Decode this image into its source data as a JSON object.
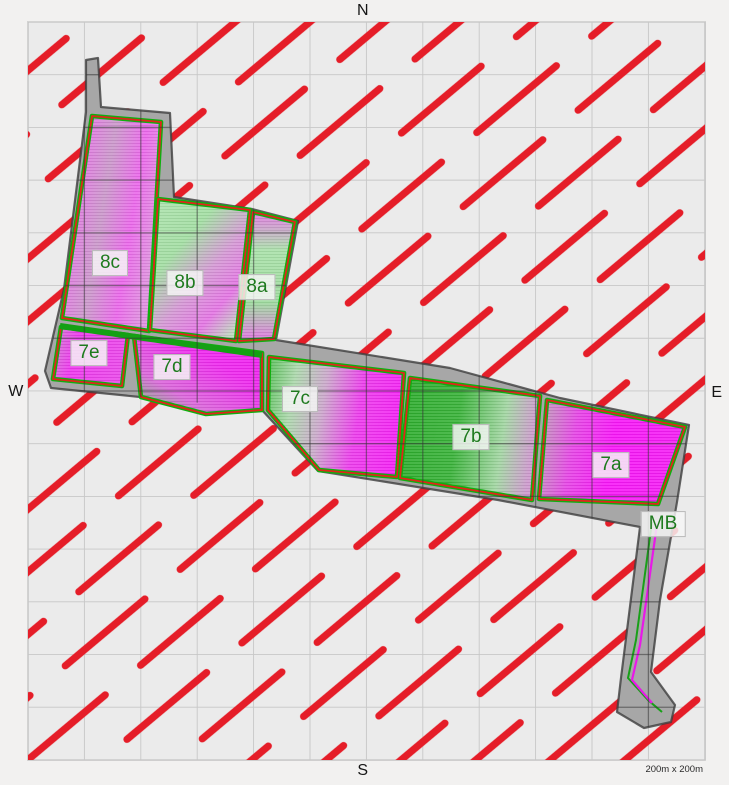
{
  "compass": {
    "north": "N",
    "south": "S",
    "west": "W",
    "east": "E"
  },
  "scale_note": "200m x 200m",
  "fields": [
    {
      "id": "8c",
      "label": "8c",
      "x": 110,
      "y": 263
    },
    {
      "id": "8b",
      "label": "8b",
      "x": 185,
      "y": 283
    },
    {
      "id": "8a",
      "label": "8a",
      "x": 257,
      "y": 287
    },
    {
      "id": "7e",
      "label": "7e",
      "x": 89,
      "y": 353
    },
    {
      "id": "7d",
      "label": "7d",
      "x": 172,
      "y": 367
    },
    {
      "id": "7c",
      "label": "7c",
      "x": 300,
      "y": 399
    },
    {
      "id": "7b",
      "label": "7b",
      "x": 471,
      "y": 437
    },
    {
      "id": "7a",
      "label": "7a",
      "x": 611,
      "y": 465
    },
    {
      "id": "MB",
      "label": "MB",
      "x": 663,
      "y": 524
    }
  ],
  "colors": {
    "hatch_red": "#e51d28",
    "boundary_gray": "#a7a7a7",
    "field_magenta": "#ee22ee",
    "field_green": "#2fae2f",
    "field_light_green": "#9edc9e",
    "label_text_green": "#1e7a1e",
    "grid_gray": "#c7c7c7"
  }
}
